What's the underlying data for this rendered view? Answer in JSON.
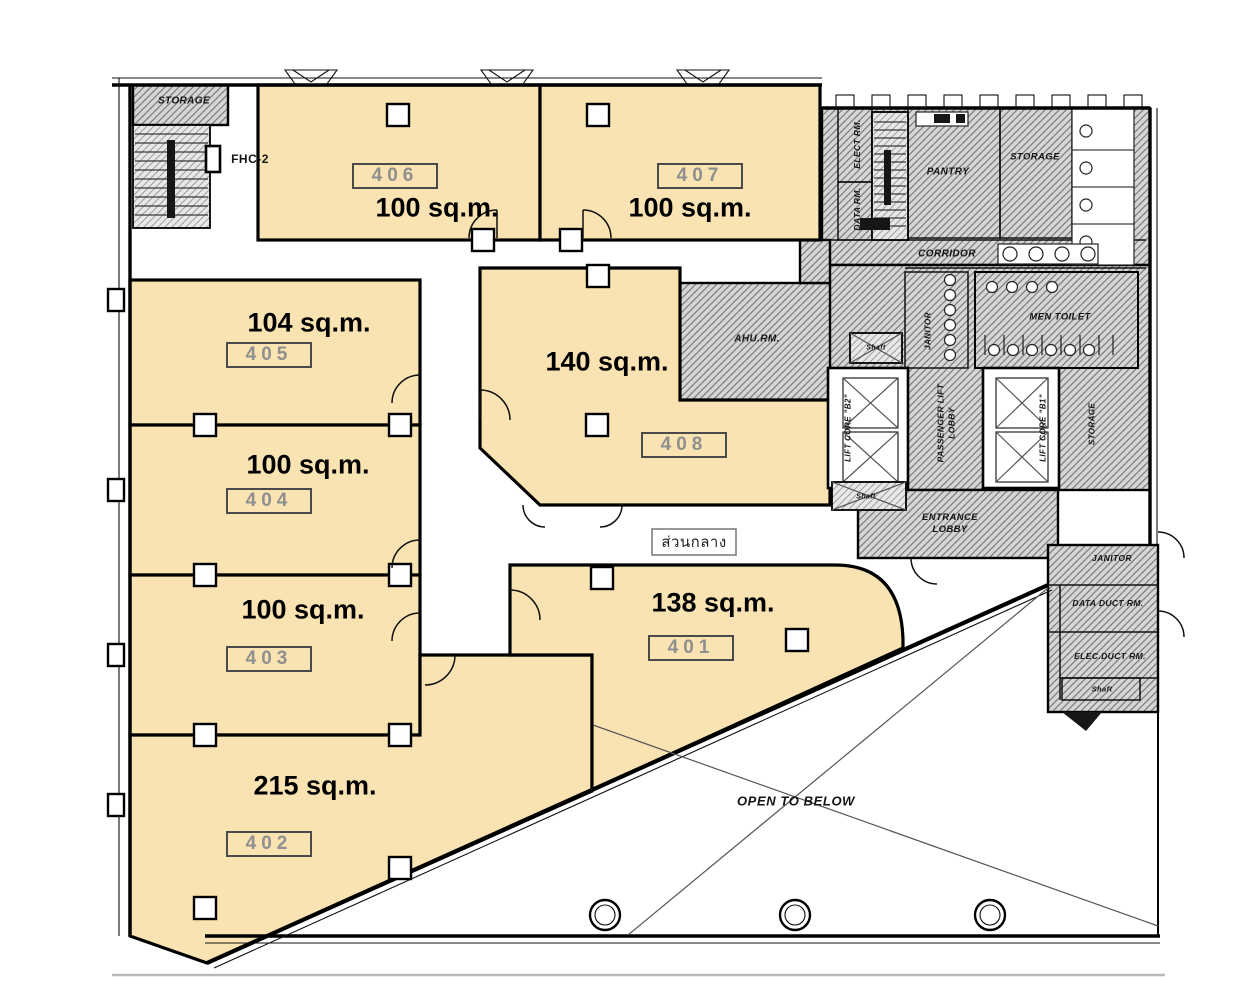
{
  "units": [
    {
      "number": "401",
      "area": "138 sq.m."
    },
    {
      "number": "402",
      "area": "215 sq.m."
    },
    {
      "number": "403",
      "area": "100 sq.m."
    },
    {
      "number": "404",
      "area": "100 sq.m."
    },
    {
      "number": "405",
      "area": "104 sq.m."
    },
    {
      "number": "406",
      "area": "100 sq.m."
    },
    {
      "number": "407",
      "area": "100 sq.m."
    },
    {
      "number": "408",
      "area": "140 sq.m."
    }
  ],
  "labels": {
    "storage_top_left": "STORAGE",
    "fhc": "FHC-2",
    "elect_rm": "ELECT RM.",
    "data_rm": "DATA RM.",
    "pantry": "PANTRY",
    "storage_top": "STORAGE",
    "corridor": "CORRIDOR",
    "janitor_left": "JANITOR",
    "men_toilet": "MEN TOILET",
    "ahu_rm": "AHU.RM.",
    "lift_core_b2": "LIFT CORE \"B2\"",
    "passenger_lift_lobby": "PASSENGER LIFT LOBBY",
    "lift_core_b1": "LIFT CORE \"B1\"",
    "storage_right": "STORAGE",
    "entrance_lobby": "ENTRANCE LOBBY",
    "janitor_right": "JANITOR",
    "data_duct_rm": "DATA DUCT RM.",
    "elec_duct_rm": "ELEC.DUCT RM.",
    "shaft": "Shaft",
    "open_to_below": "OPEN TO BELOW",
    "common_area_thai": "ส่วนกลาง"
  },
  "colors": {
    "unit_fill": "#F9E3B3",
    "hatch_bg": "#D6D6D6",
    "hatch_line": "#7C7C7C",
    "wall": "#000000"
  }
}
